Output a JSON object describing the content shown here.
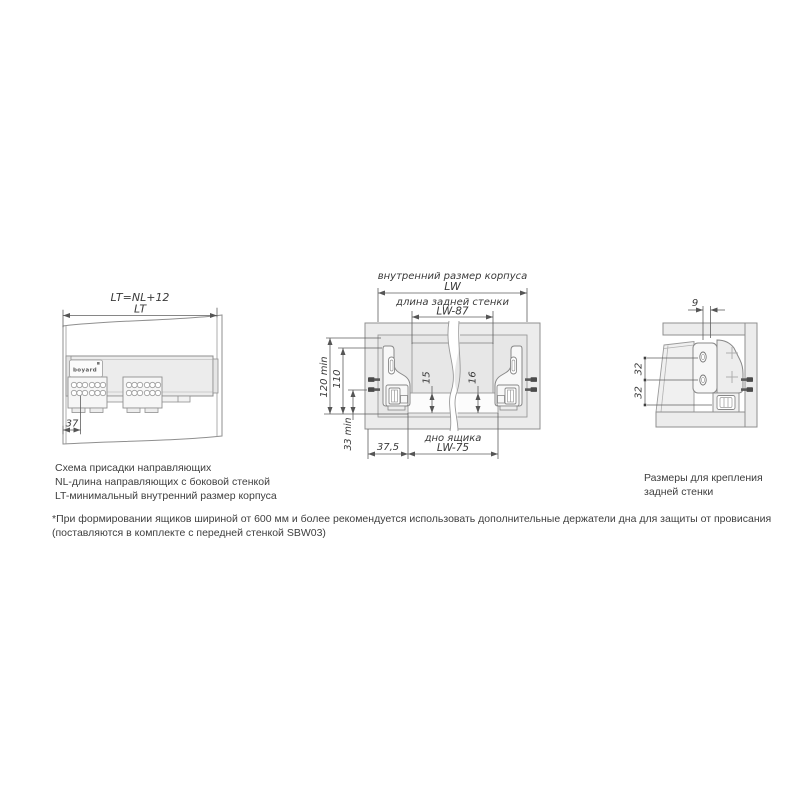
{
  "left_diagram": {
    "formula": "LT=NL+12",
    "lt": "LT",
    "d37": "37",
    "logo": "boyard"
  },
  "middle_diagram": {
    "inner_size_label": "внутренний размер корпуса",
    "lw": "LW",
    "back_wall_label": "длина задней стенки",
    "lw87": "LW-87",
    "d120": "120 min",
    "d110": "110",
    "d33": "33 min",
    "d15": "15",
    "d16": "16",
    "d375": "37,5",
    "bottom_label": "дно ящика",
    "lw75": "LW-75"
  },
  "right_diagram": {
    "d9": "9",
    "d32a": "32",
    "d32b": "32"
  },
  "captions": {
    "left_line1": "Схема присадки направляющих",
    "left_line2": "NL-длина направляющих с боковой стенкой",
    "left_line3": "LT-минимальный внутренний размер корпуса",
    "right_line1": "Размеры для крепления",
    "right_line2": "задней стенки"
  },
  "footnote": {
    "line1": "*При формировании ящиков шириной от 600 мм и более рекомендуется использовать дополнительные держатели дна для защиты от провисания",
    "line2": "(поставляются в комплекте с передней стенкой SBW03)"
  },
  "colors": {
    "drawing_line": "#8f8f8f",
    "dim_line": "#5f5f5f",
    "panel_fill": "#ececec",
    "text": "#3a3a3a",
    "pin": "#4b4b4b"
  }
}
